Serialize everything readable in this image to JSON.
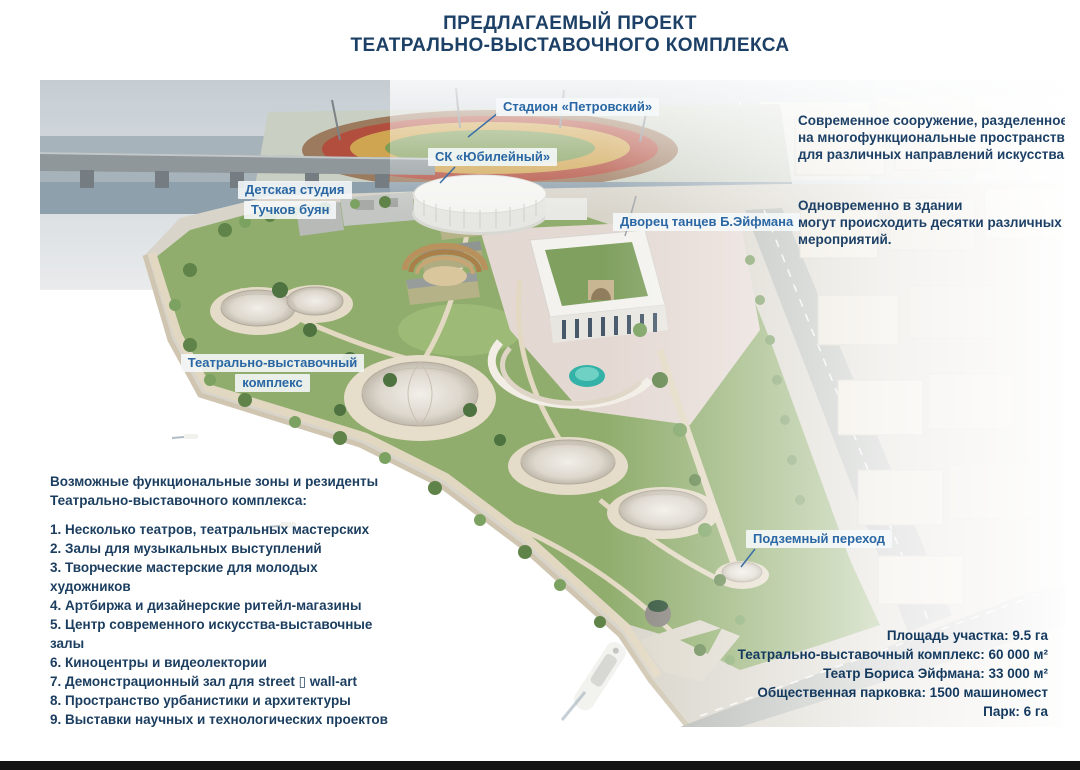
{
  "page": {
    "title_line1": "ПРЕДЛАГАЕМЫЙ ПРОЕКТ",
    "title_line2": "ТЕАТРАЛЬНО-ВЫСТАВОЧНОГО КОМПЛЕКСА"
  },
  "map_labels": {
    "stadium": "Стадион «Петровский»",
    "yubileyny": "СК «Юбилейный»",
    "detskaya_line1": "Детская студия",
    "detskaya_line2": "Тучков буян",
    "eifman": "Дворец танцев Б.Эйфмана",
    "tvk_line1": "Театрально-выставочный",
    "tvk_line2": "комплекс",
    "perehod": "Подземный переход"
  },
  "description": {
    "para1": "Современное сооружение, разделенное\nна многофункциональные пространства\nдля различных направлений  искусства.",
    "para2": "Одновременно в здании\nмогут  происходить десятки различных\nмероприятий."
  },
  "functional_zones": {
    "heading": "Возможные функциональные зоны и резиденты\nТеатрально-выставочного комплекса:",
    "items": [
      "1. Несколько театров, театральных мастерских",
      "2. Залы для музыкальных выступлений",
      "3. Творческие мастерские для молодых художников",
      "4. Артбиржа и дизайнерские ритейл-магазины",
      "5. Центр современного искусства-выставочные залы",
      "6. Киноцентры и видеолектории",
      "7. Демонстрационный зал для street ▯ wall-art",
      "8. Пространство урбанистики и архитектуры",
      "9. Выставки научных и технологических  проектов - Science Art",
      "10. Гастрономический кластер - фудкорт, воркшопы и мастеркласс",
      "11. Зеленая зона в атриуме"
    ]
  },
  "stats": {
    "lines": [
      "Площадь участка: 9.5 га",
      "Театрально-выставочный комплекс: 60 000 м²",
      "Театр Бориса Эйфмана: 33 000 м²",
      "Общественная парковка: 1500 машиномест",
      "Парк: 6 га"
    ]
  },
  "colors": {
    "title_navy": "#1d4066",
    "label_blue": "#2a67a4",
    "body_navy": "#1b3d5f",
    "water": "#54687a",
    "park_green": "#90ad6d",
    "pool_teal": "#34b2a8",
    "bottom_bar": "#141414"
  }
}
